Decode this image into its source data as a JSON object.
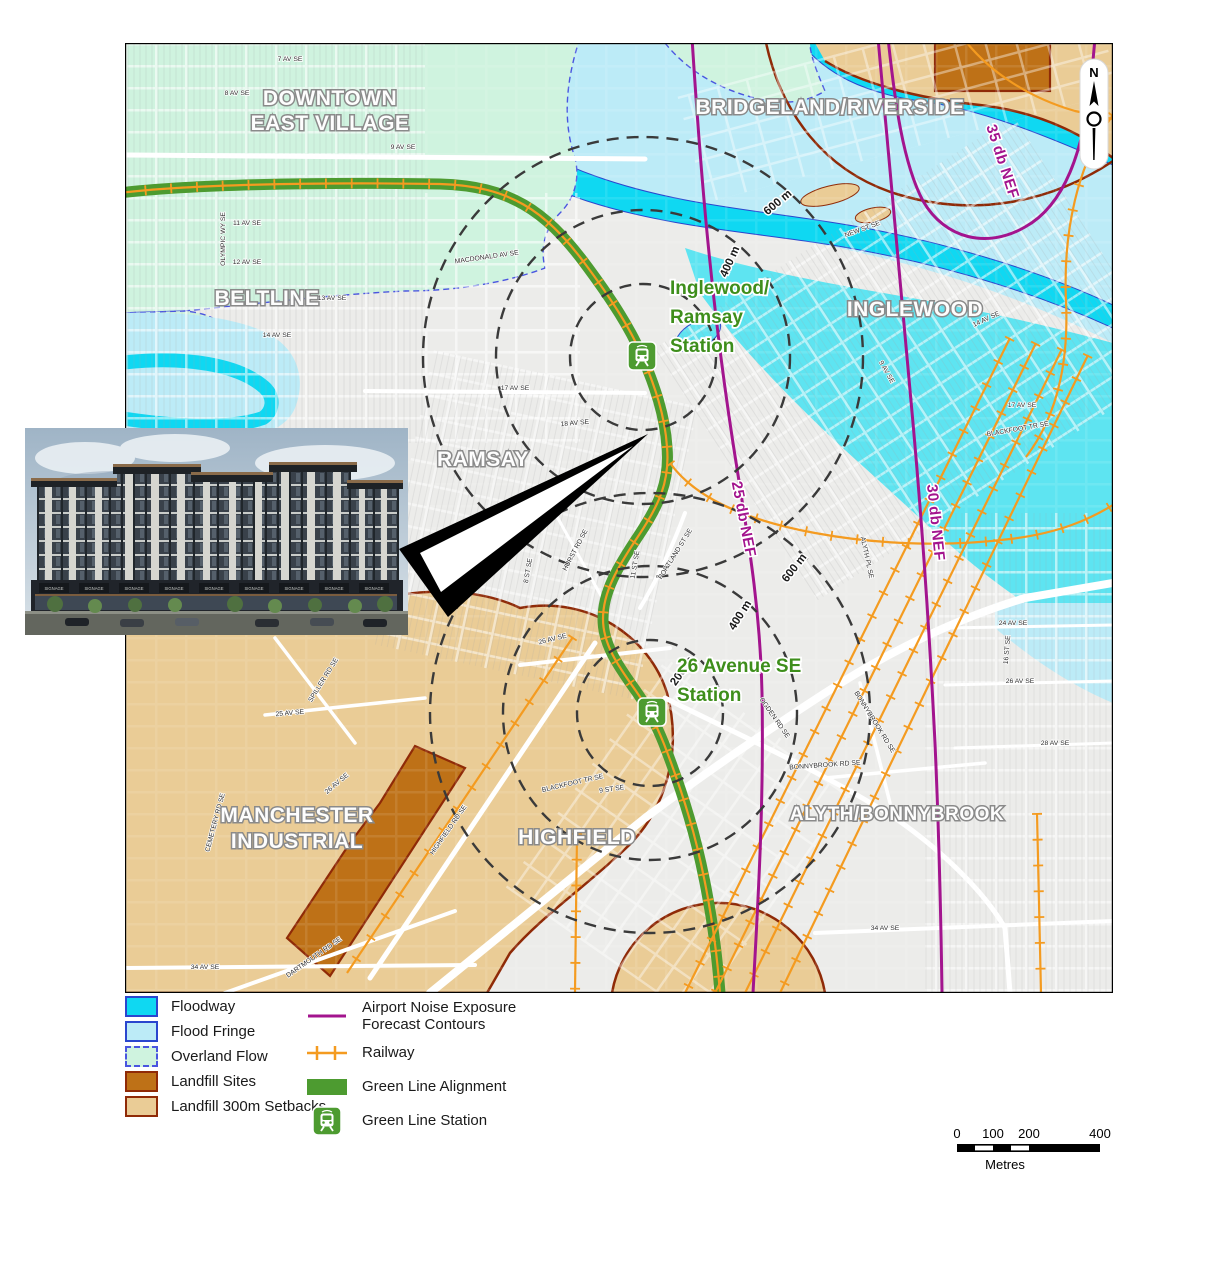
{
  "map": {
    "north_letter": "N",
    "neighborhoods": [
      {
        "lines": [
          "DOWNTOWN",
          "EAST VILLAGE"
        ],
        "x": 205,
        "y": 62,
        "size": 21,
        "lh": 25
      },
      {
        "lines": [
          "BELTLINE"
        ],
        "x": 142,
        "y": 262,
        "size": 21,
        "lh": 24
      },
      {
        "lines": [
          "BRIDGELAND/RIVERSIDE"
        ],
        "x": 705,
        "y": 71,
        "size": 21,
        "lh": 24
      },
      {
        "lines": [
          "INGLEWOOD"
        ],
        "x": 790,
        "y": 273,
        "size": 21,
        "lh": 24
      },
      {
        "lines": [
          "RAMSAY"
        ],
        "x": 358,
        "y": 423,
        "size": 21,
        "lh": 24
      },
      {
        "lines": [
          "MANCHESTER",
          "INDUSTRIAL"
        ],
        "x": 172,
        "y": 779,
        "size": 21,
        "lh": 26
      },
      {
        "lines": [
          "HIGHFIELD"
        ],
        "x": 452,
        "y": 801,
        "size": 21,
        "lh": 24
      },
      {
        "lines": [
          "ALYTH/BONNYBROOK"
        ],
        "x": 772,
        "y": 777,
        "size": 19,
        "lh": 22
      }
    ],
    "stations": [
      {
        "lines": [
          "Inglewood/",
          "Ramsay",
          "Station"
        ],
        "tx": 545,
        "ty": 251,
        "lh": 29,
        "icon_x": 502,
        "icon_y": 298
      },
      {
        "lines": [
          "26 Avenue SE",
          "Station"
        ],
        "tx": 552,
        "ty": 629,
        "lh": 29,
        "icon_x": 512,
        "icon_y": 654
      }
    ],
    "nef_labels": [
      {
        "text": "25 db NEF",
        "x": 614,
        "y": 477,
        "rot": 79
      },
      {
        "text": "30 db NEF",
        "x": 806,
        "y": 480,
        "rot": 84
      },
      {
        "text": "35 db NEF",
        "x": 873,
        "y": 120,
        "rot": 72
      }
    ],
    "ring_labels": [
      {
        "text": "600 m",
        "x": 655,
        "y": 162,
        "rot": -40
      },
      {
        "text": "400 m",
        "x": 608,
        "y": 220,
        "rot": -66
      },
      {
        "text": "600 m",
        "x": 672,
        "y": 527,
        "rot": -52
      },
      {
        "text": "400 m",
        "x": 618,
        "y": 574,
        "rot": -58
      },
      {
        "text": "200 m",
        "x": 560,
        "y": 630,
        "rot": -55
      }
    ],
    "street_labels": [
      {
        "text": "7 AV SE",
        "x": 165,
        "y": 18,
        "rot": 0
      },
      {
        "text": "8 AV SE",
        "x": 112,
        "y": 52,
        "rot": 0
      },
      {
        "text": "9 AV SE",
        "x": 278,
        "y": 106,
        "rot": 0
      },
      {
        "text": "11 AV SE",
        "x": 122,
        "y": 182,
        "rot": 0
      },
      {
        "text": "OLYMPIC WY SE",
        "x": 100,
        "y": 196,
        "rot": -90
      },
      {
        "text": "12 AV SE",
        "x": 122,
        "y": 221,
        "rot": 0
      },
      {
        "text": "13 AV SE",
        "x": 207,
        "y": 257,
        "rot": 0
      },
      {
        "text": "14 AV SE",
        "x": 152,
        "y": 294,
        "rot": 0
      },
      {
        "text": "MACDONALD AV SE",
        "x": 362,
        "y": 216,
        "rot": -8
      },
      {
        "text": "17 AV SE",
        "x": 390,
        "y": 347,
        "rot": 0
      },
      {
        "text": "18 AV SE",
        "x": 450,
        "y": 382,
        "rot": -5
      },
      {
        "text": "20 AV SE",
        "x": 440,
        "y": 442,
        "rot": -10
      },
      {
        "text": "22 AV SE",
        "x": 358,
        "y": 505,
        "rot": -12
      },
      {
        "text": "8 ST SE",
        "x": 405,
        "y": 528,
        "rot": -80
      },
      {
        "text": "11 ST SE",
        "x": 512,
        "y": 522,
        "rot": -80
      },
      {
        "text": "PORTLAND ST SE",
        "x": 552,
        "y": 512,
        "rot": -58
      },
      {
        "text": "HURST RD SE",
        "x": 452,
        "y": 508,
        "rot": -62
      },
      {
        "text": "26 AV SE",
        "x": 428,
        "y": 598,
        "rot": -14
      },
      {
        "text": "25 AV SE",
        "x": 165,
        "y": 672,
        "rot": -5
      },
      {
        "text": "SPILLER RD SE",
        "x": 200,
        "y": 638,
        "rot": -58
      },
      {
        "text": "CEMETERY RD SE",
        "x": 92,
        "y": 780,
        "rot": -75
      },
      {
        "text": "26 AV SE",
        "x": 213,
        "y": 742,
        "rot": -40
      },
      {
        "text": "HIGHFIELD RD SE",
        "x": 325,
        "y": 788,
        "rot": -55
      },
      {
        "text": "DARTMOUTH RD SE",
        "x": 190,
        "y": 916,
        "rot": -35
      },
      {
        "text": "34 AV SE",
        "x": 80,
        "y": 926,
        "rot": 0
      },
      {
        "text": "34 AV SE",
        "x": 760,
        "y": 887,
        "rot": 0
      },
      {
        "text": "BLACKFOOT TR SE",
        "x": 448,
        "y": 742,
        "rot": -13
      },
      {
        "text": "9 ST SE",
        "x": 487,
        "y": 748,
        "rot": -8
      },
      {
        "text": "OGDEN RD SE",
        "x": 648,
        "y": 676,
        "rot": 55
      },
      {
        "text": "BONNYBROOK RD SE",
        "x": 700,
        "y": 724,
        "rot": -4
      },
      {
        "text": "BONNYBROOK RD SE",
        "x": 748,
        "y": 680,
        "rot": 58
      },
      {
        "text": "ALYTH PL SE",
        "x": 740,
        "y": 515,
        "rot": 78
      },
      {
        "text": "24 AV SE",
        "x": 888,
        "y": 582,
        "rot": 0
      },
      {
        "text": "26 AV SE",
        "x": 895,
        "y": 640,
        "rot": 0
      },
      {
        "text": "28 AV SE",
        "x": 930,
        "y": 702,
        "rot": 0
      },
      {
        "text": "16 ST SE",
        "x": 884,
        "y": 607,
        "rot": -85
      },
      {
        "text": "17 AV SE",
        "x": 897,
        "y": 364,
        "rot": 0
      },
      {
        "text": "BLACKFOOT TR SE",
        "x": 893,
        "y": 388,
        "rot": -10
      },
      {
        "text": "NEW ST SE",
        "x": 738,
        "y": 188,
        "rot": -20
      },
      {
        "text": "14 AV SE",
        "x": 862,
        "y": 278,
        "rot": -25
      },
      {
        "text": "9 AV SE",
        "x": 760,
        "y": 330,
        "rot": 60
      }
    ]
  },
  "photo": {
    "storefront_sign": "SIGNAGE",
    "sign_count": 9
  },
  "legend": {
    "left": [
      {
        "type": "floodway",
        "label": "Floodway"
      },
      {
        "type": "fringe",
        "label": "Flood Fringe"
      },
      {
        "type": "overland",
        "label": "Overland Flow"
      },
      {
        "type": "landfill",
        "label": "Landfill Sites"
      },
      {
        "type": "setback",
        "label": "Landfill 300m Setbacks"
      }
    ],
    "right": [
      {
        "type": "nef-line",
        "lines": [
          "Airport Noise Exposure",
          "Forecast Contours"
        ]
      },
      {
        "type": "railway",
        "lines": [
          "Railway"
        ]
      },
      {
        "type": "greenline",
        "lines": [
          "Green Line Alignment"
        ]
      },
      {
        "type": "station",
        "lines": [
          "Green Line Station"
        ]
      }
    ]
  },
  "scalebar": {
    "ticks": [
      {
        "label": "0",
        "x": 0
      },
      {
        "label": "100",
        "x": 36
      },
      {
        "label": "200",
        "x": 72
      },
      {
        "label": "400",
        "x": 143
      }
    ],
    "unit": "Metres"
  },
  "colors": {
    "floodway": "#0FD8F2",
    "flood_fringe": "#BCEBF7",
    "overland_flow": "#CFF3DF",
    "landfill": "#BE7117",
    "setback": "#EACC96",
    "setback_border": "#8F2A07",
    "nef_contour": "#A3148E",
    "railway": "#F49B20",
    "green_line": "#4D9B30",
    "station_label": "#3E8E1B",
    "water_border": "#2A46CE"
  }
}
